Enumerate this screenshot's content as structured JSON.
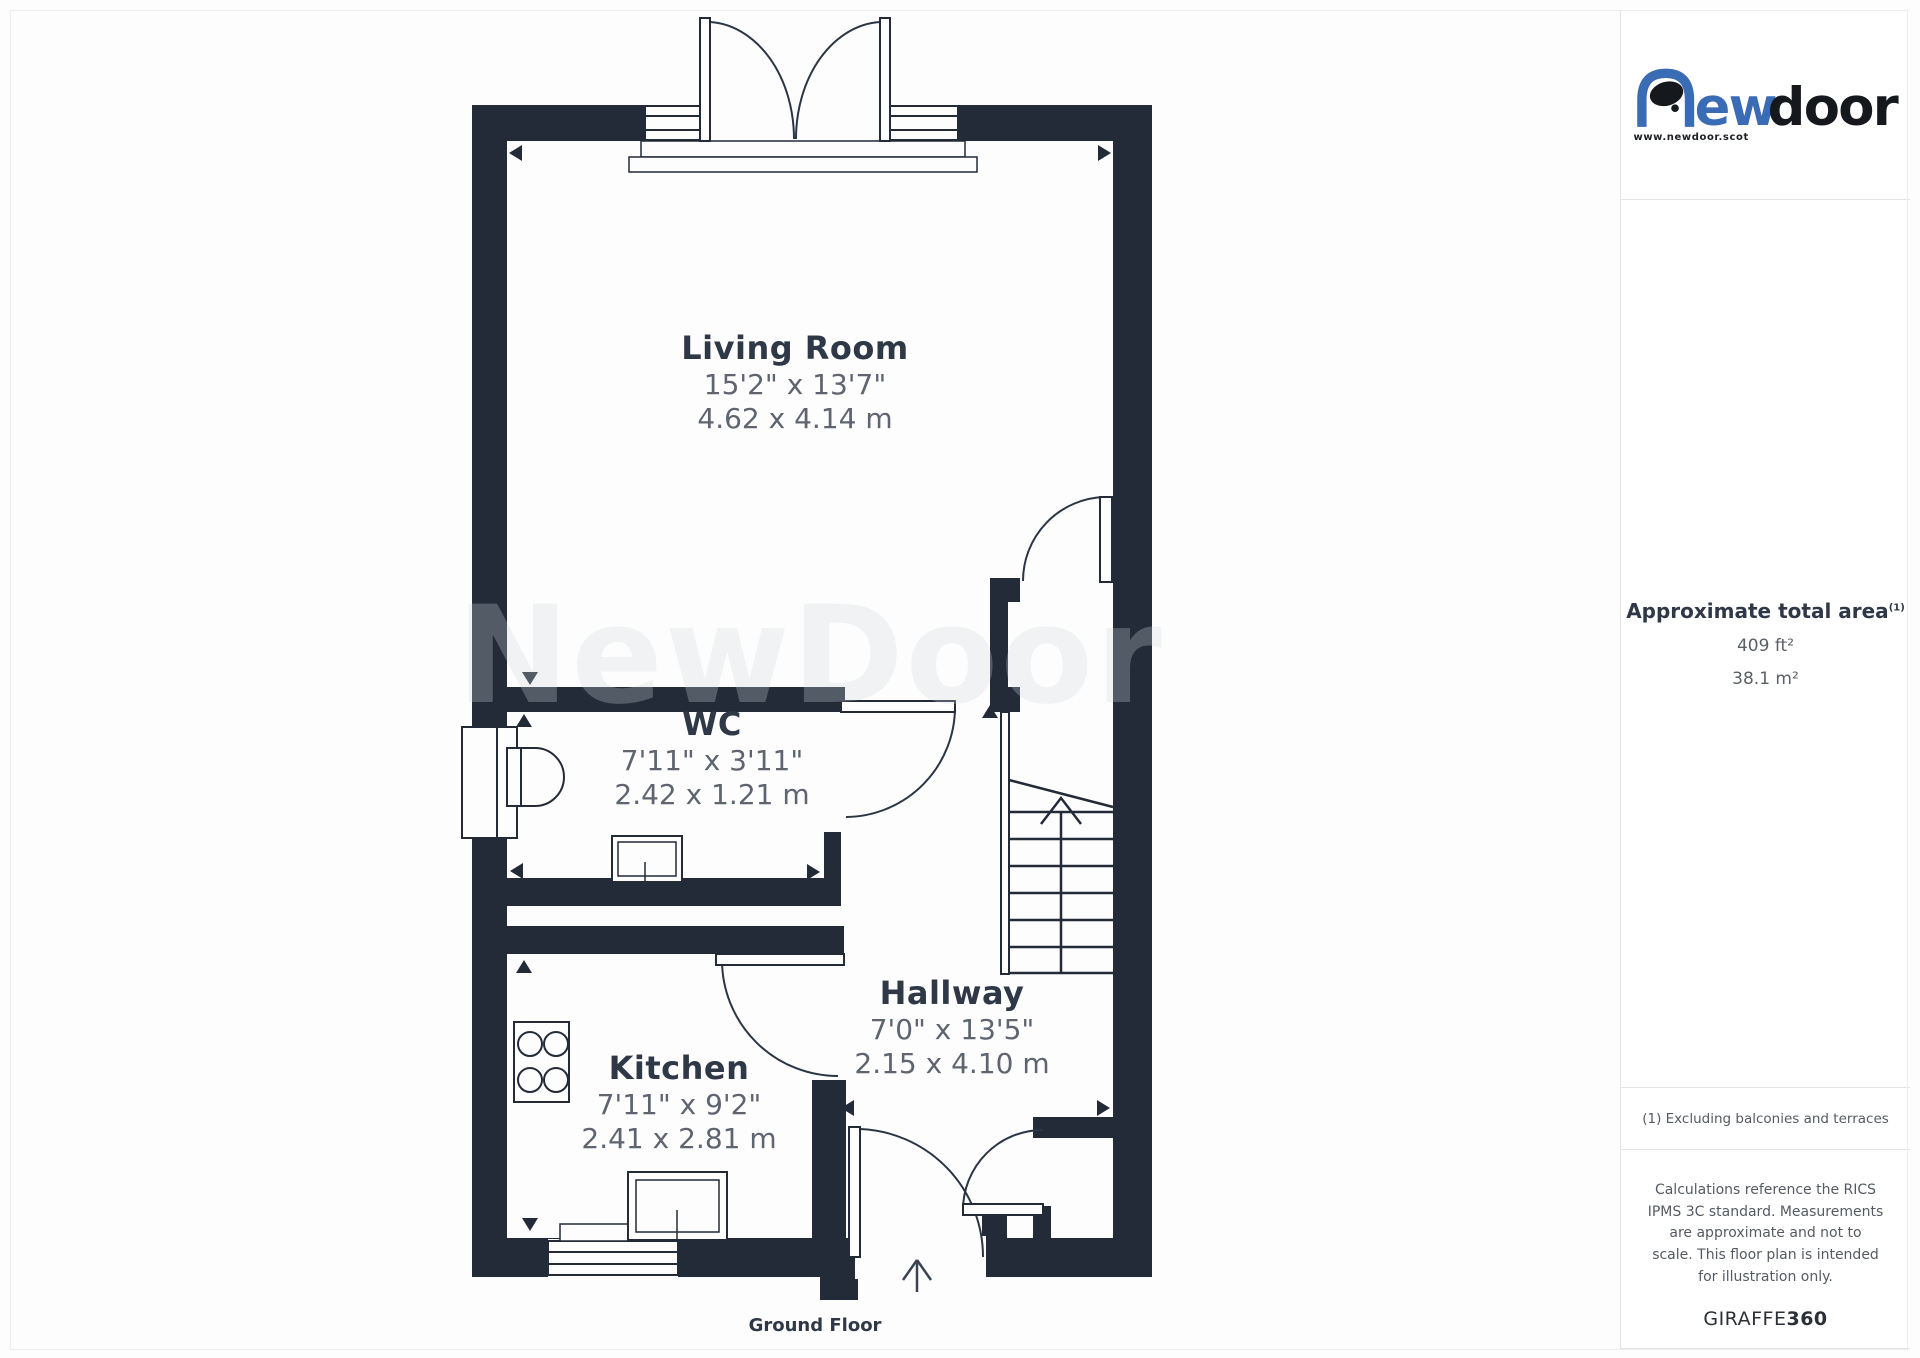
{
  "floor_plan": {
    "watermark": "NewDoor",
    "floor_label": "Ground Floor",
    "rooms": [
      {
        "name": "Living Room",
        "imperial": "15'2\" x 13'7\"",
        "metric": "4.62 x 4.14 m"
      },
      {
        "name": "WC",
        "imperial": "7'11\" x 3'11\"",
        "metric": "2.42 x 1.21 m"
      },
      {
        "name": "Kitchen",
        "imperial": "7'11\" x 9'2\"",
        "metric": "2.41 x 2.81 m"
      },
      {
        "name": "Hallway",
        "imperial": "7'0\" x 13'5\"",
        "metric": "2.15 x 4.10 m"
      }
    ]
  },
  "sidebar": {
    "logo": {
      "text_blue": "ew",
      "text_black": "door",
      "website": "www.newdoor.scot"
    },
    "area": {
      "title": "Approximate total area",
      "footnote_ref": "(1)",
      "imperial": "409 ft²",
      "metric": "38.1 m²"
    },
    "footnote": "(1) Excluding balconies and terraces",
    "disclaimer": "Calculations reference the RICS IPMS 3C standard. Measurements are approximate and not to scale. This floor plan is intended for illustration only.",
    "provider_name": "GIRAFFE",
    "provider_suffix": "360"
  },
  "colors": {
    "wall": "#232b39",
    "room_title": "#2e3847",
    "dimension_text": "#5e6570",
    "brand_blue": "#3a6cb5",
    "brand_black": "#15181c",
    "divider": "#e4e4e4"
  }
}
